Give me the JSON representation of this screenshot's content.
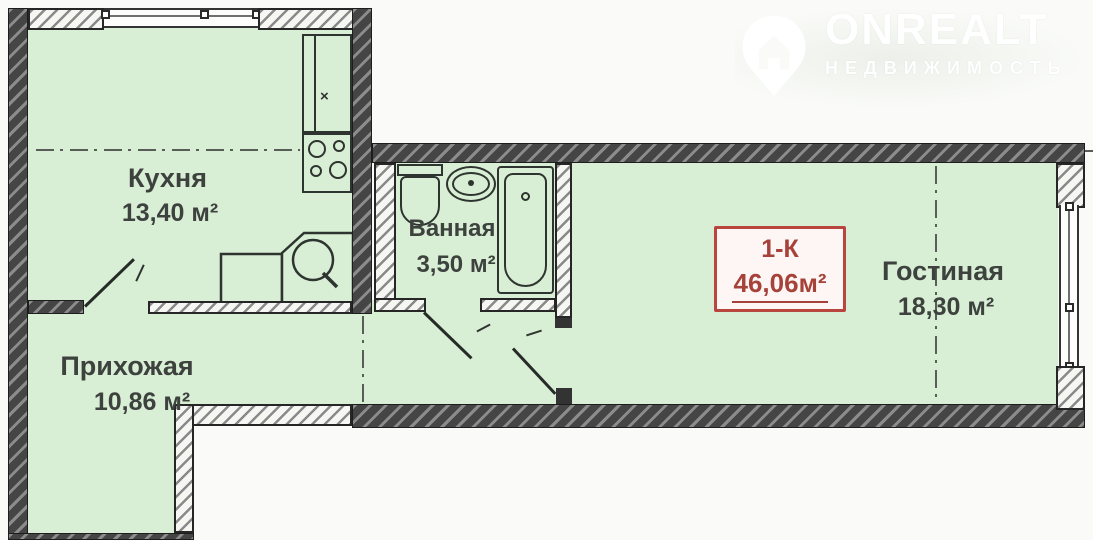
{
  "watermark": {
    "brand": "ONREALT",
    "tagline": "НЕДВИЖИМОСТЬ",
    "icon": "location-pin-house-icon"
  },
  "summary_box": {
    "type": "1-К",
    "area": "46,06м²"
  },
  "rooms": [
    {
      "name": "Кухня",
      "area": "13,40 м²"
    },
    {
      "name": "Ванная",
      "area": "3,50 м²"
    },
    {
      "name": "Гостиная",
      "area": "18,30 м²"
    },
    {
      "name": "Прихожая",
      "area": "10,86 м²"
    }
  ],
  "colors": {
    "floor_fill": "#d9efd5",
    "wall_dark": "#454545",
    "accent_red": "#b8453e",
    "label_text": "#3d423e"
  },
  "fixtures": [
    "stove-icon",
    "kitchen-cabinet-icon",
    "kitchen-sink-icon",
    "toilet-icon",
    "washbasin-icon",
    "bathtub-icon"
  ]
}
